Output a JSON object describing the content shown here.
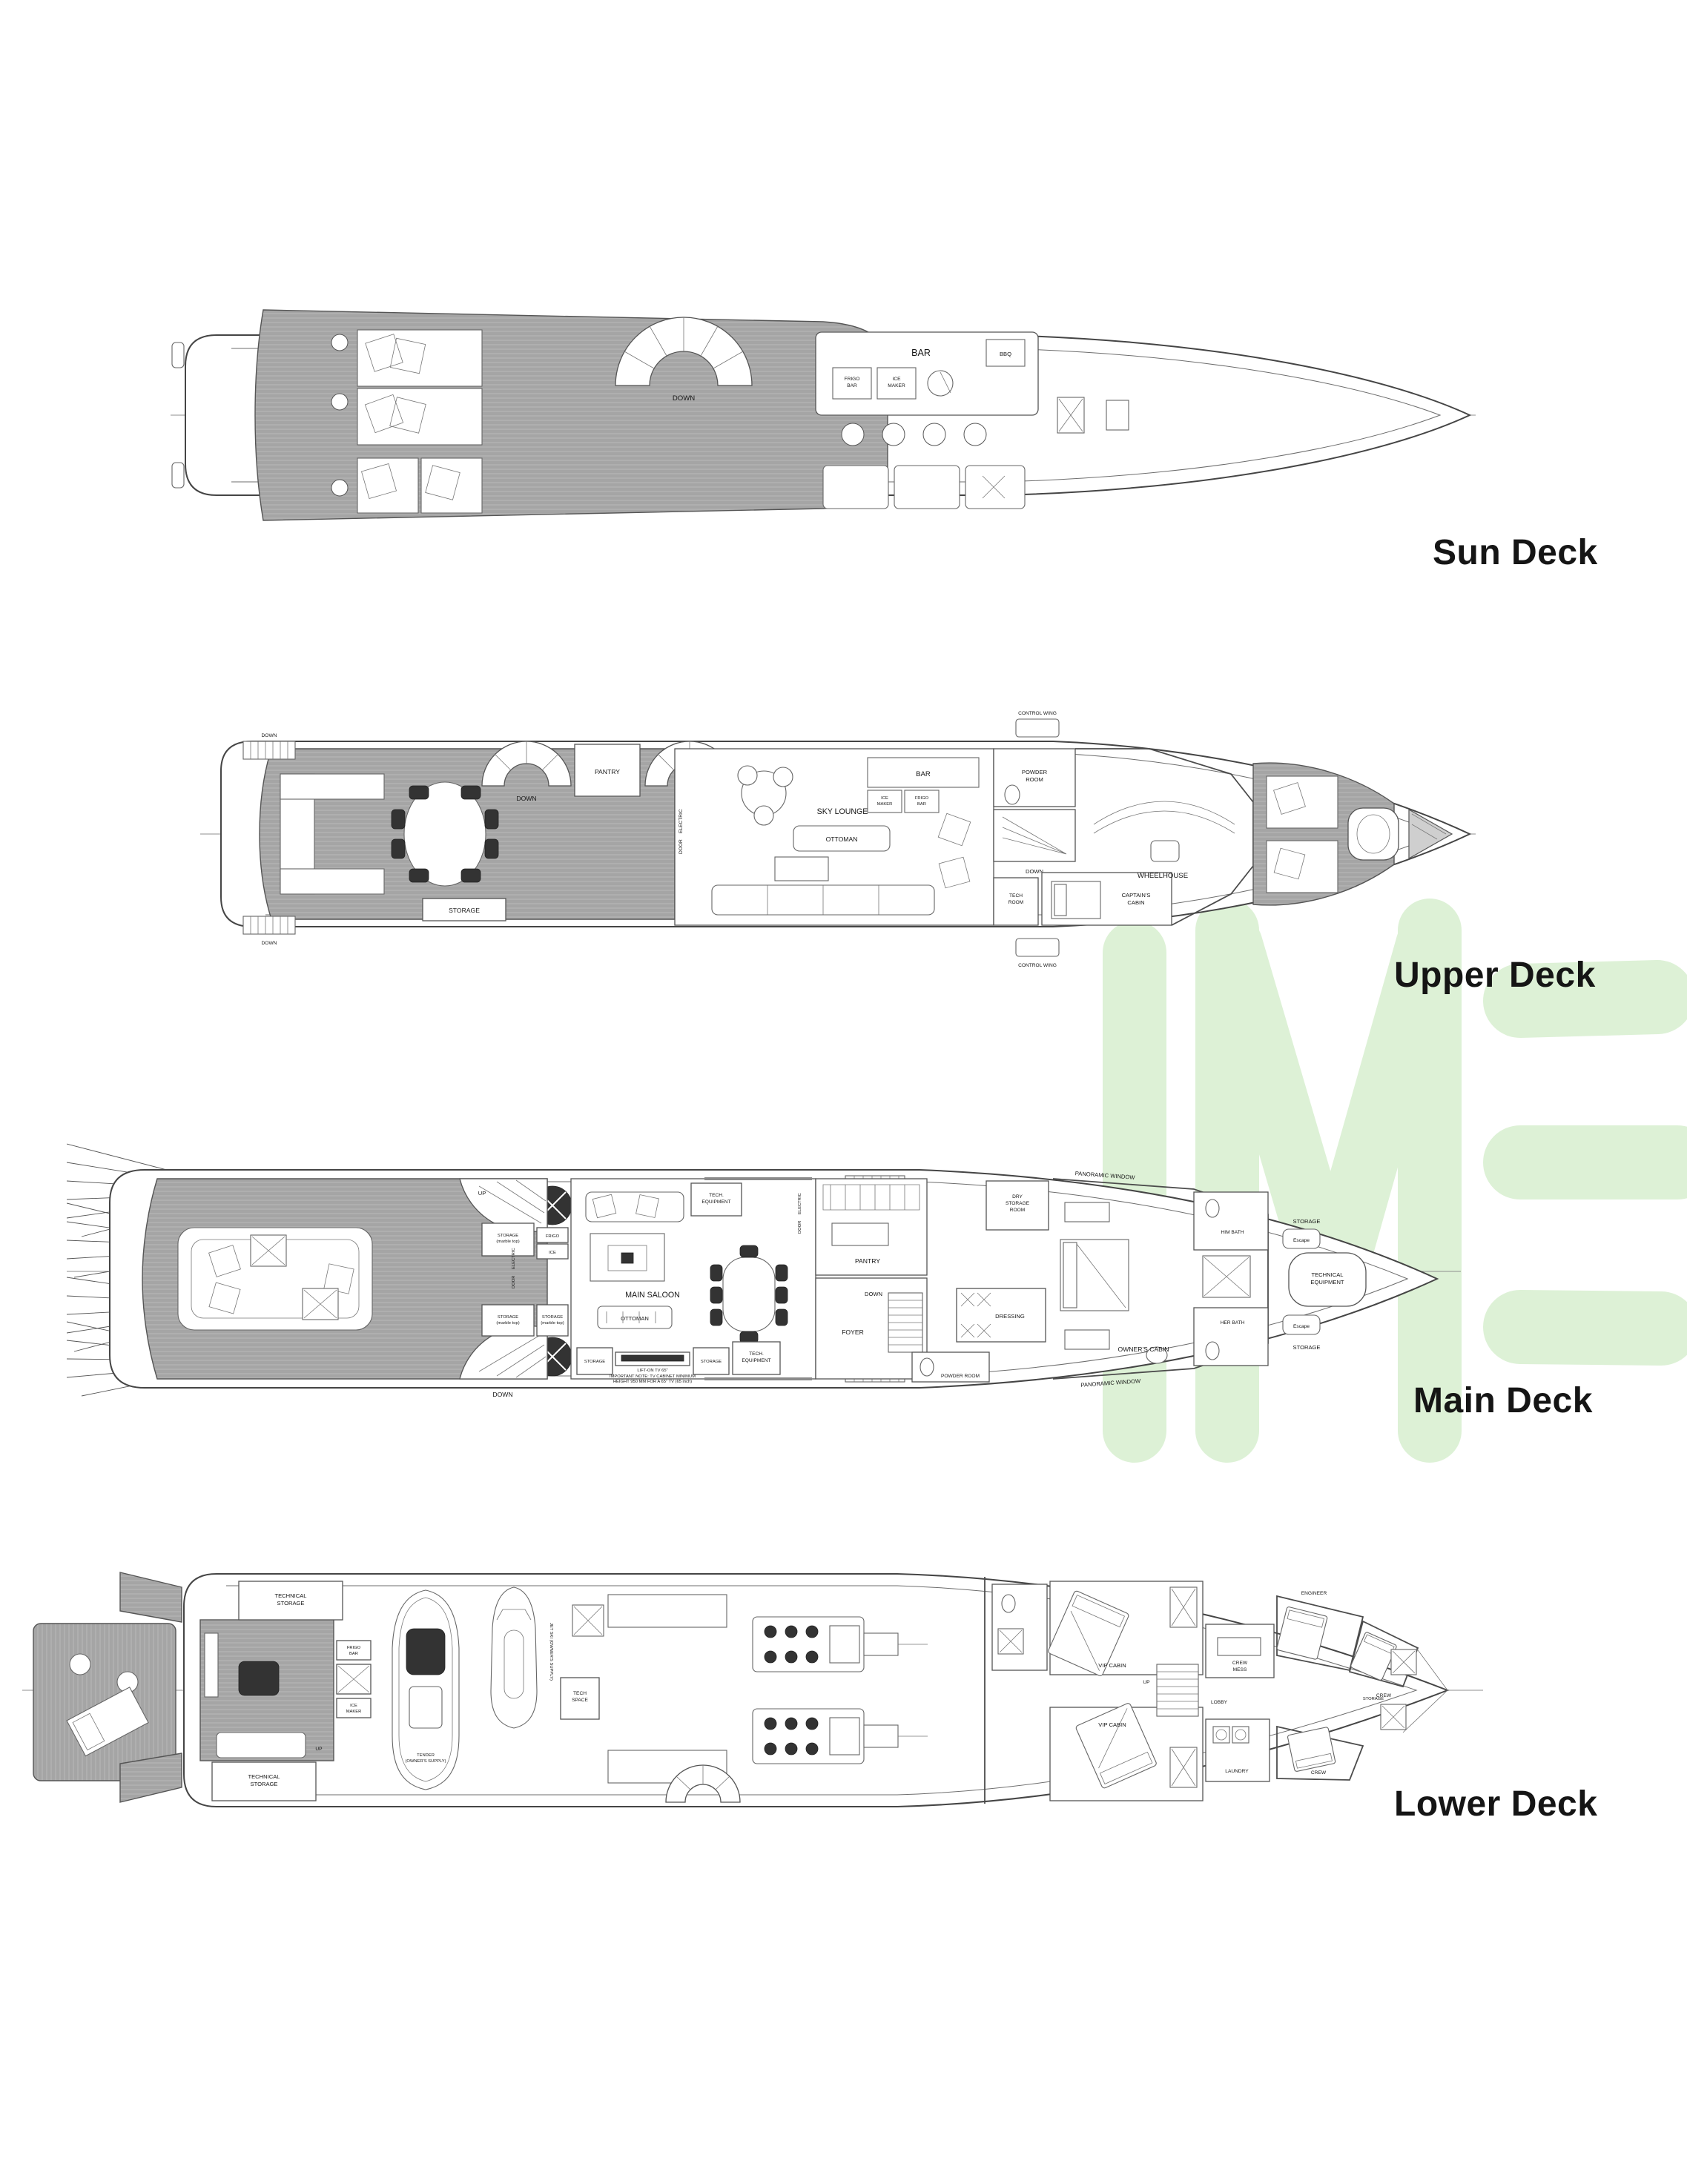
{
  "titles": {
    "sun": "Sun Deck",
    "upper": "Upper Deck",
    "main": "Main Deck",
    "lower": "Lower Deck"
  },
  "watermark": {
    "letters": "IME",
    "color": "#ddf1d6"
  },
  "sun": {
    "down": "DOWN",
    "bar": "BAR",
    "frigo_bar_1": "FRIGO",
    "frigo_bar_2": "BAR",
    "ice_maker_1": "ICE",
    "ice_maker_2": "MAKER",
    "bbq": "BBQ"
  },
  "upper": {
    "control_wing": "CONTROL WING",
    "pantry": "PANTRY",
    "down": "DOWN",
    "up": "UP",
    "storage": "STORAGE",
    "sky_lounge": "SKY LOUNGE",
    "ottoman": "OTTOMAN",
    "electric_door_1": "ELECTRIC",
    "electric_door_2": "DOOR",
    "bar": "BAR",
    "ice_maker_1": "ICE",
    "ice_maker_2": "MAKER",
    "frigo_bar_1": "FRIGO",
    "frigo_bar_2": "BAR",
    "powder_room_1": "POWDER",
    "powder_room_2": "ROOM",
    "tech_room_1": "TECH",
    "tech_room_2": "ROOM",
    "captains_cabin_1": "CAPTAIN'S",
    "captains_cabin_2": "CABIN",
    "wheelhouse": "WHEELHOUSE"
  },
  "main": {
    "panoramic_window": "PANORAMIC WINDOW",
    "tech_equipment_1": "TECH.",
    "tech_equipment_2": "EQUIPMENT",
    "storage_marble_1": "STORAGE",
    "storage_marble_2": "(marble top)",
    "frigo_bar_1": "FRIGO",
    "frigo_bar_2": "BAR",
    "ice_maker_1": "ICE",
    "ice_maker_2": "MAKER",
    "electric_door_1": "ELECTRIC",
    "electric_door_2": "DOOR",
    "main_saloon": "MAIN SALOON",
    "ottoman": "OTTOMAN",
    "storage": "STORAGE",
    "tv_lift": "LIFT-ON TV 65\"",
    "tv_note_1": "IMPORTANT NOTE: TV CABINET MINIMUM",
    "tv_note_2": "HEIGHT 950 MM FOR A 65\" TV (65 inch)",
    "up": "UP",
    "down": "DOWN",
    "pantry": "PANTRY",
    "foyer": "FOYER",
    "dressing": "DRESSING",
    "owners_cabin": "OWNER'S CABIN",
    "him_bath": "HIM BATH",
    "her_bath": "HER BATH",
    "technical_equipment_1": "TECHNICAL",
    "technical_equipment_2": "EQUIPMENT",
    "storage_fwd": "STORAGE",
    "escape": "Escape",
    "powder_room": "POWDER ROOM",
    "dry_storage_1": "DRY",
    "dry_storage_2": "STORAGE",
    "dry_storage_3": "ROOM"
  },
  "lower": {
    "technical_storage_1": "TECHNICAL",
    "technical_storage_2": "STORAGE",
    "frigo_bar_1": "FRIGO",
    "frigo_bar_2": "BAR",
    "ice_maker_1": "ICE",
    "ice_maker_2": "MAKER",
    "tender_1": "TENDER",
    "tender_2": "(OWNER'S SUPPLY)",
    "jet_ski": "JET SKI (OWNER'S SUPPLY)",
    "tech_space_1": "TECH",
    "tech_space_2": "SPACE",
    "up": "UP",
    "vip_cabin": "VIP CABIN",
    "lobby": "LOBBY",
    "crew_mess_1": "CREW",
    "crew_mess_2": "MESS",
    "laundry": "LAUNDRY",
    "engineer": "ENGINEER",
    "crew": "CREW",
    "storage": "STORAGE"
  }
}
